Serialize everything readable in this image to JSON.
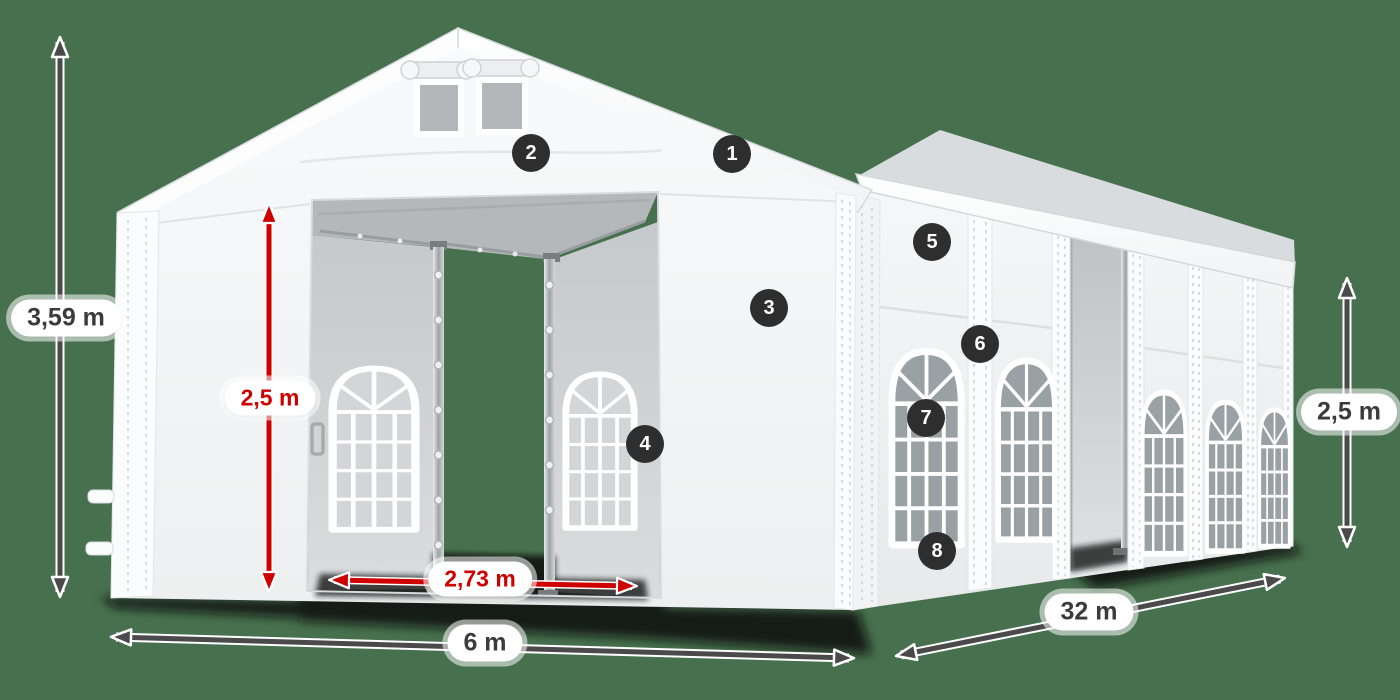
{
  "scene": {
    "subject": "white marquee tent dimension diagram",
    "background_color": "#47714E"
  },
  "colors": {
    "dimension_red": "#CE0000",
    "dimension_dark": "#4A4A4A",
    "badge_background": "#2E2E2E",
    "badge_text": "#FFFFFF",
    "label_pill_background": "#FFFFFF",
    "label_text_dark": "#3B3B3B"
  },
  "dimensions": {
    "total_height": "3,59 m",
    "door_height": "2,5 m",
    "door_width": "2,73 m",
    "front_width": "6 m",
    "side_length": "32 m",
    "side_wall_height": "2,5 m"
  },
  "badges": [
    {
      "number": "1"
    },
    {
      "number": "2"
    },
    {
      "number": "3"
    },
    {
      "number": "4"
    },
    {
      "number": "5"
    },
    {
      "number": "6"
    },
    {
      "number": "7"
    },
    {
      "number": "8"
    }
  ]
}
